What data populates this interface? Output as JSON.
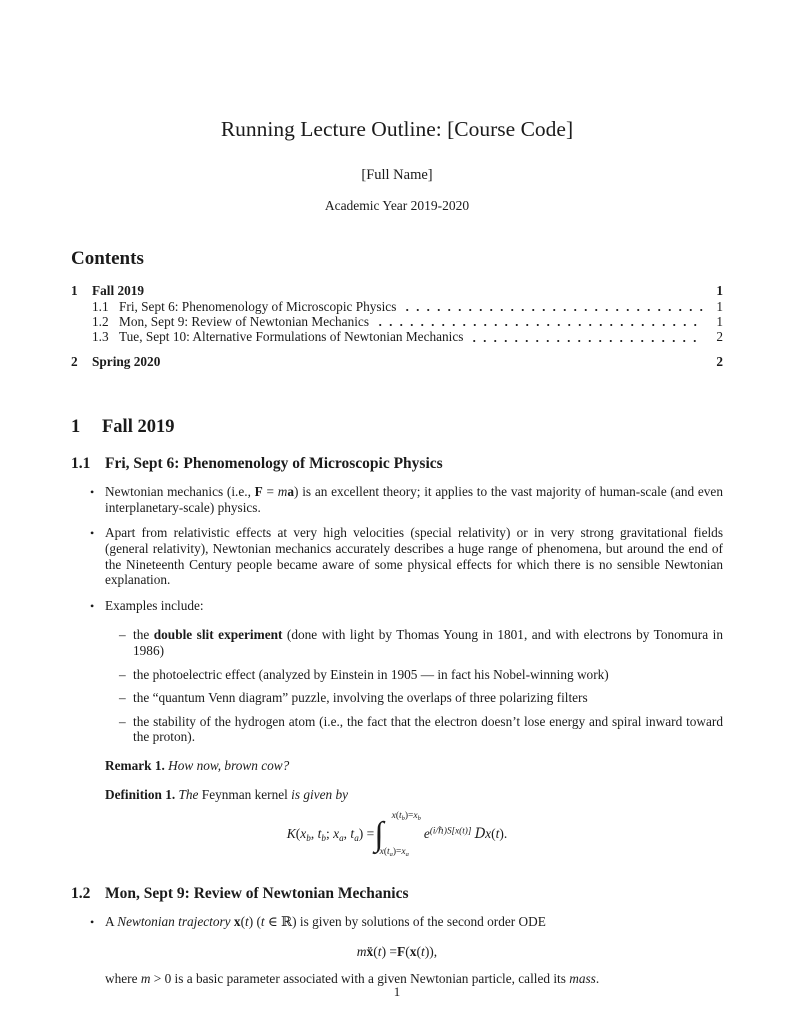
{
  "colors": {
    "paper": "#ffffff",
    "ink": "#1b1b1b"
  },
  "header": {
    "title": "Running Lecture Outline: [Course Code]",
    "author": "[Full Name]",
    "date": "Academic Year 2019-2020"
  },
  "toc": {
    "heading": "Contents",
    "entries": [
      {
        "level": 1,
        "number": "1",
        "label": "Fall 2019",
        "page": "1"
      },
      {
        "level": 2,
        "number": "1.1",
        "label": "Fri, Sept 6: Phenomenology of Microscopic Physics",
        "page": "1"
      },
      {
        "level": 2,
        "number": "1.2",
        "label": "Mon, Sept 9: Review of Newtonian Mechanics",
        "page": "1"
      },
      {
        "level": 2,
        "number": "1.3",
        "label": "Tue, Sept 10: Alternative Formulations of Newtonian Mechanics",
        "page": "2"
      },
      {
        "level": 1,
        "number": "2",
        "label": "Spring 2020",
        "page": "2"
      }
    ]
  },
  "doc": {
    "section1": {
      "number": "1",
      "title": "Fall 2019"
    },
    "sub11": {
      "number": "1.1",
      "title": "Fri, Sept 6: Phenomenology of Microscopic Physics"
    },
    "bullet_marker": "•",
    "dash_marker": "–",
    "b1": [
      {
        "t": "Newtonian mechanics (i.e., "
      },
      {
        "t": "F",
        "b": true
      },
      {
        "t": " = "
      },
      {
        "t": "m",
        "i": true
      },
      {
        "t": "a",
        "b": true
      },
      {
        "t": ") is an excellent theory; it applies to the vast majority of human-scale (and even interplanetary-scale) physics."
      }
    ],
    "b2": [
      {
        "t": "Apart from relativistic effects at very high velocities (special relativity) or in very strong gravitational fields (general relativity), Newtonian mechanics accurately describes a huge range of phenomena, but around the end of the Nineteenth Century people became aware of some physical effects for which there is no sensible Newtonian explanation."
      }
    ],
    "b3": [
      {
        "t": "Examples include:"
      }
    ],
    "ex1": [
      {
        "t": "the "
      },
      {
        "t": "double slit experiment",
        "b": true
      },
      {
        "t": " (done with light by Thomas Young in 1801, and with electrons by Tonomura in 1986)"
      }
    ],
    "ex2": [
      {
        "t": "the photoelectric effect (analyzed by Einstein in 1905 — in fact his Nobel-winning work)"
      }
    ],
    "ex3": [
      {
        "t": "the “quantum Venn diagram” puzzle, involving the overlaps of three polarizing filters"
      }
    ],
    "ex4": [
      {
        "t": "the stability of the hydrogen atom (i.e., the fact that the electron doesn’t lose energy and spiral inward toward the proton)."
      }
    ],
    "remark": [
      {
        "t": "Remark 1.",
        "b": true
      },
      {
        "t": " "
      },
      {
        "t": "How now, brown cow?",
        "i": true
      }
    ],
    "definition": [
      {
        "t": "Definition 1.",
        "b": true
      },
      {
        "t": " "
      },
      {
        "t": "The ",
        "i": true
      },
      {
        "t": "Feynman kernel"
      },
      {
        "t": " is given by",
        "i": true
      }
    ],
    "kernel": {
      "lhs": [
        {
          "t": "K",
          "i": true
        },
        {
          "t": "("
        },
        {
          "t": "x",
          "i": true
        },
        {
          "t": "b",
          "i": true,
          "sub": true
        },
        {
          "t": ", "
        },
        {
          "t": "t",
          "i": true
        },
        {
          "t": "b",
          "i": true,
          "sub": true
        },
        {
          "t": "; "
        },
        {
          "t": "x",
          "i": true
        },
        {
          "t": "a",
          "i": true,
          "sub": true
        },
        {
          "t": ", "
        },
        {
          "t": "t",
          "i": true
        },
        {
          "t": "a",
          "i": true,
          "sub": true
        },
        {
          "t": ") = "
        }
      ],
      "integral_sign": "∫",
      "upper": [
        {
          "t": "x",
          "i": true
        },
        {
          "t": "("
        },
        {
          "t": "t",
          "i": true
        },
        {
          "t": "b",
          "i": true,
          "sub": true
        },
        {
          "t": ")="
        },
        {
          "t": "x",
          "i": true
        },
        {
          "t": "b",
          "i": true,
          "sub": true
        }
      ],
      "lower": [
        {
          "t": "x",
          "i": true
        },
        {
          "t": "("
        },
        {
          "t": "t",
          "i": true
        },
        {
          "t": "a",
          "i": true,
          "sub": true
        },
        {
          "t": ")="
        },
        {
          "t": "x",
          "i": true
        },
        {
          "t": "a",
          "i": true,
          "sub": true
        }
      ],
      "integrand": [
        {
          "t": "e",
          "i": true
        },
        {
          "t": "(i/ℏ)S[x(t)]",
          "i": true,
          "sup": true
        },
        {
          "t": " "
        },
        {
          "t": "D",
          "i": true,
          "cls": "scr"
        },
        {
          "t": "x",
          "i": true
        },
        {
          "t": "("
        },
        {
          "t": "t",
          "i": true
        },
        {
          "t": ")."
        }
      ]
    },
    "sub12": {
      "number": "1.2",
      "title": "Mon, Sept 9: Review of Newtonian Mechanics"
    },
    "b4": [
      {
        "t": "A "
      },
      {
        "t": "Newtonian trajectory",
        "i": true
      },
      {
        "t": " "
      },
      {
        "t": "x",
        "b": true
      },
      {
        "t": "("
      },
      {
        "t": "t",
        "i": true
      },
      {
        "t": ") ("
      },
      {
        "t": "t",
        "i": true
      },
      {
        "t": " ∈ ℝ) is given by solutions of the second order ODE"
      }
    ],
    "ode": [
      {
        "t": "m",
        "i": true
      },
      {
        "t": " "
      },
      {
        "t": "ẍ",
        "b": true
      },
      {
        "t": "("
      },
      {
        "t": "t",
        "i": true
      },
      {
        "t": ") = "
      },
      {
        "t": "F",
        "b": true
      },
      {
        "t": "("
      },
      {
        "t": "x",
        "b": true
      },
      {
        "t": "("
      },
      {
        "t": "t",
        "i": true
      },
      {
        "t": ")),"
      }
    ],
    "where": [
      {
        "t": "where "
      },
      {
        "t": "m",
        "i": true
      },
      {
        "t": " > 0 is a basic parameter associated with a given Newtonian particle, called its "
      },
      {
        "t": "mass",
        "i": true
      },
      {
        "t": "."
      }
    ]
  },
  "footer": {
    "page_number": "1"
  }
}
